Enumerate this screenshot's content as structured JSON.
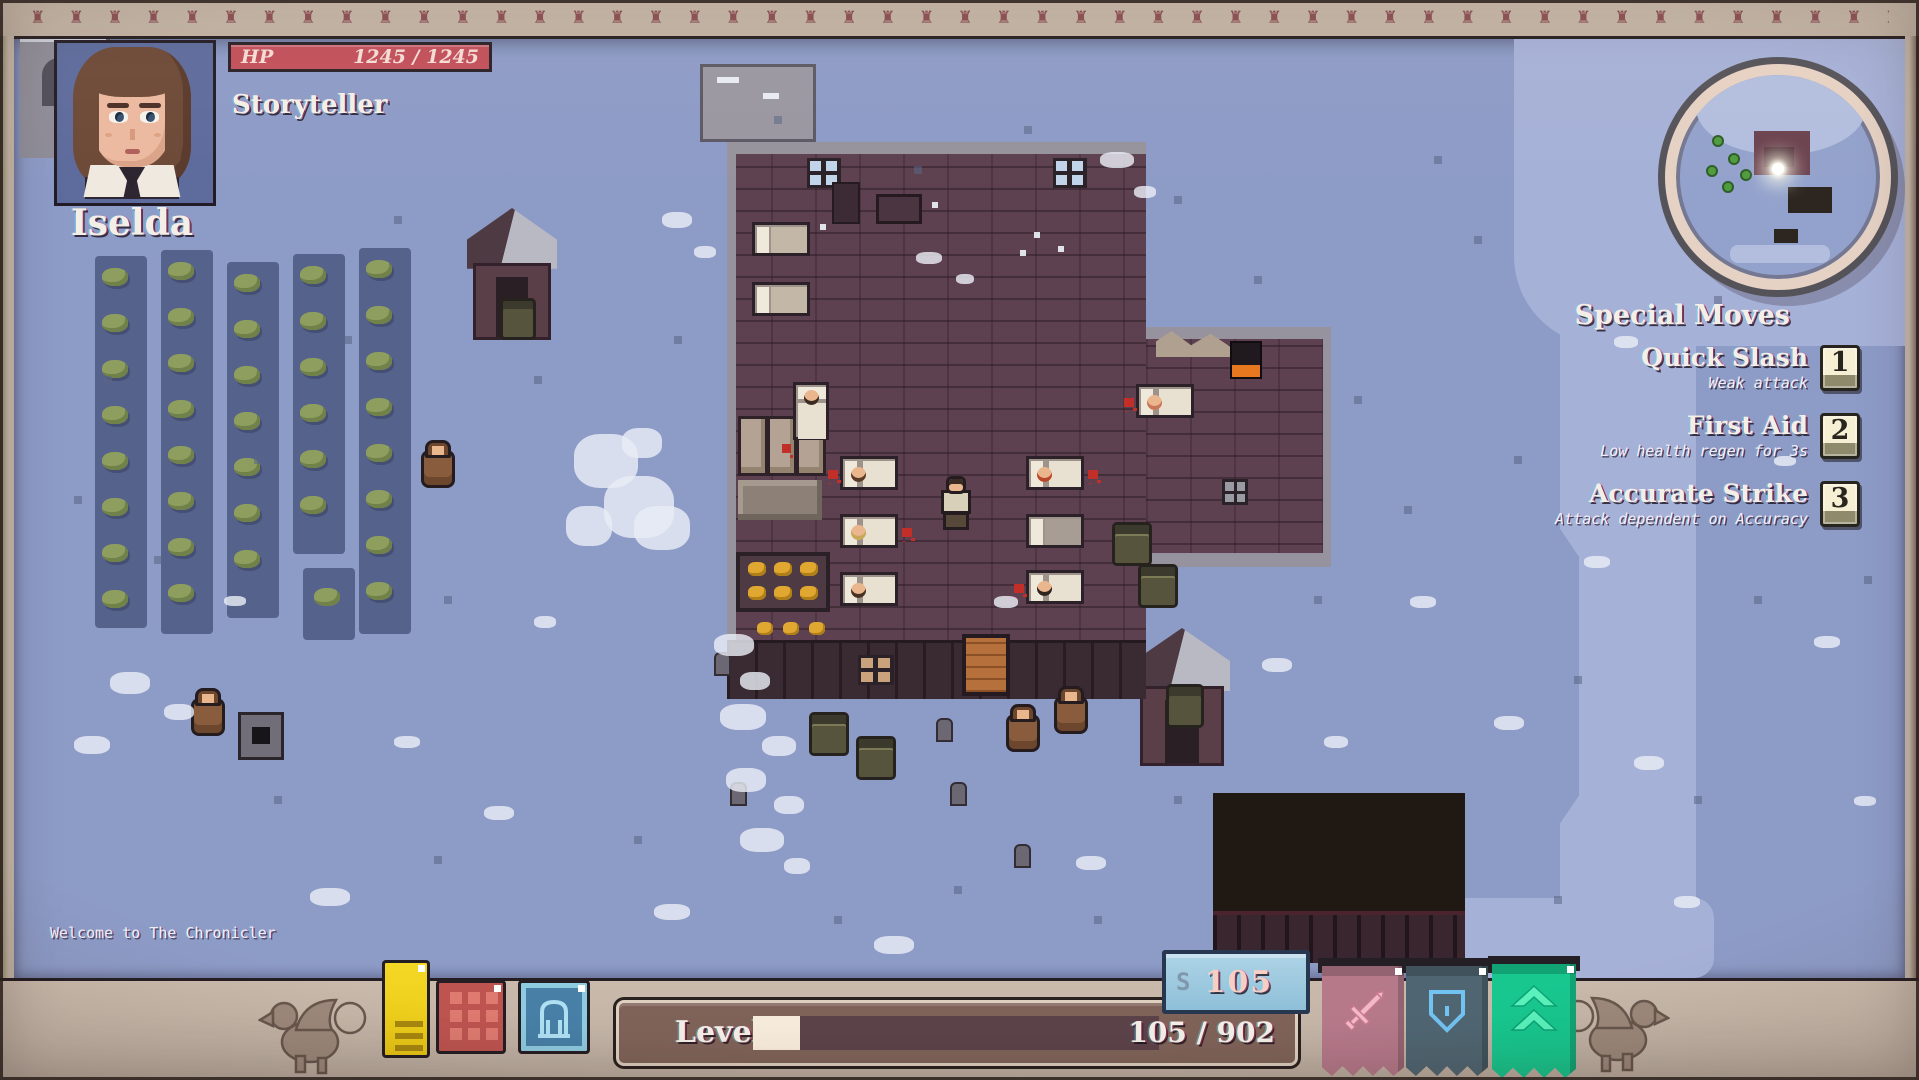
{
  "hud": {
    "portrait": {
      "name": "Iselda",
      "class_label": "Storyteller"
    },
    "hp": {
      "label": "HP",
      "value": "1245 / 1245"
    },
    "special_moves": {
      "title": "Special Moves",
      "moves": [
        {
          "name": "Quick Slash",
          "desc": "Weak attack",
          "key": "1"
        },
        {
          "name": "First Aid",
          "desc": "Low health regen for 3s",
          "key": "2"
        },
        {
          "name": "Accurate Strike",
          "desc": "Attack dependent on Accuracy",
          "key": "3"
        }
      ]
    },
    "message_log": "Welcome to The Chronicler",
    "level": {
      "label": "Level 10",
      "xp_text": "105 / 902",
      "xp_current": 105,
      "xp_max": 902
    },
    "currency": {
      "symbol": "S",
      "amount": "105"
    },
    "toolbar_icons": [
      {
        "name": "notes-icon"
      },
      {
        "name": "inventory-grid-icon"
      },
      {
        "name": "character-icon"
      }
    ],
    "banners": [
      {
        "name": "attack-banner",
        "icon": "sword-icon",
        "color": "#b5798a"
      },
      {
        "name": "defense-banner",
        "icon": "shield-icon",
        "color": "#4f6672"
      },
      {
        "name": "agility-banner",
        "icon": "chevrons-icon",
        "color": "#17c78e"
      }
    ]
  },
  "colors": {
    "frame": "#c6b7a9",
    "ground": "#8d9bc7",
    "ground_light": "#a6b1d8",
    "building_brick": "#5d4150",
    "hp_bar": "#c2505c",
    "xp_fill": "#f7ecdc",
    "xp_track": "#5c4349",
    "currency_box": "#9ccadf",
    "keycap": "#f0e7cb",
    "icon_yellow": "#f2cf1e",
    "icon_red": "#bd5450",
    "icon_blue": "#477fa6"
  }
}
